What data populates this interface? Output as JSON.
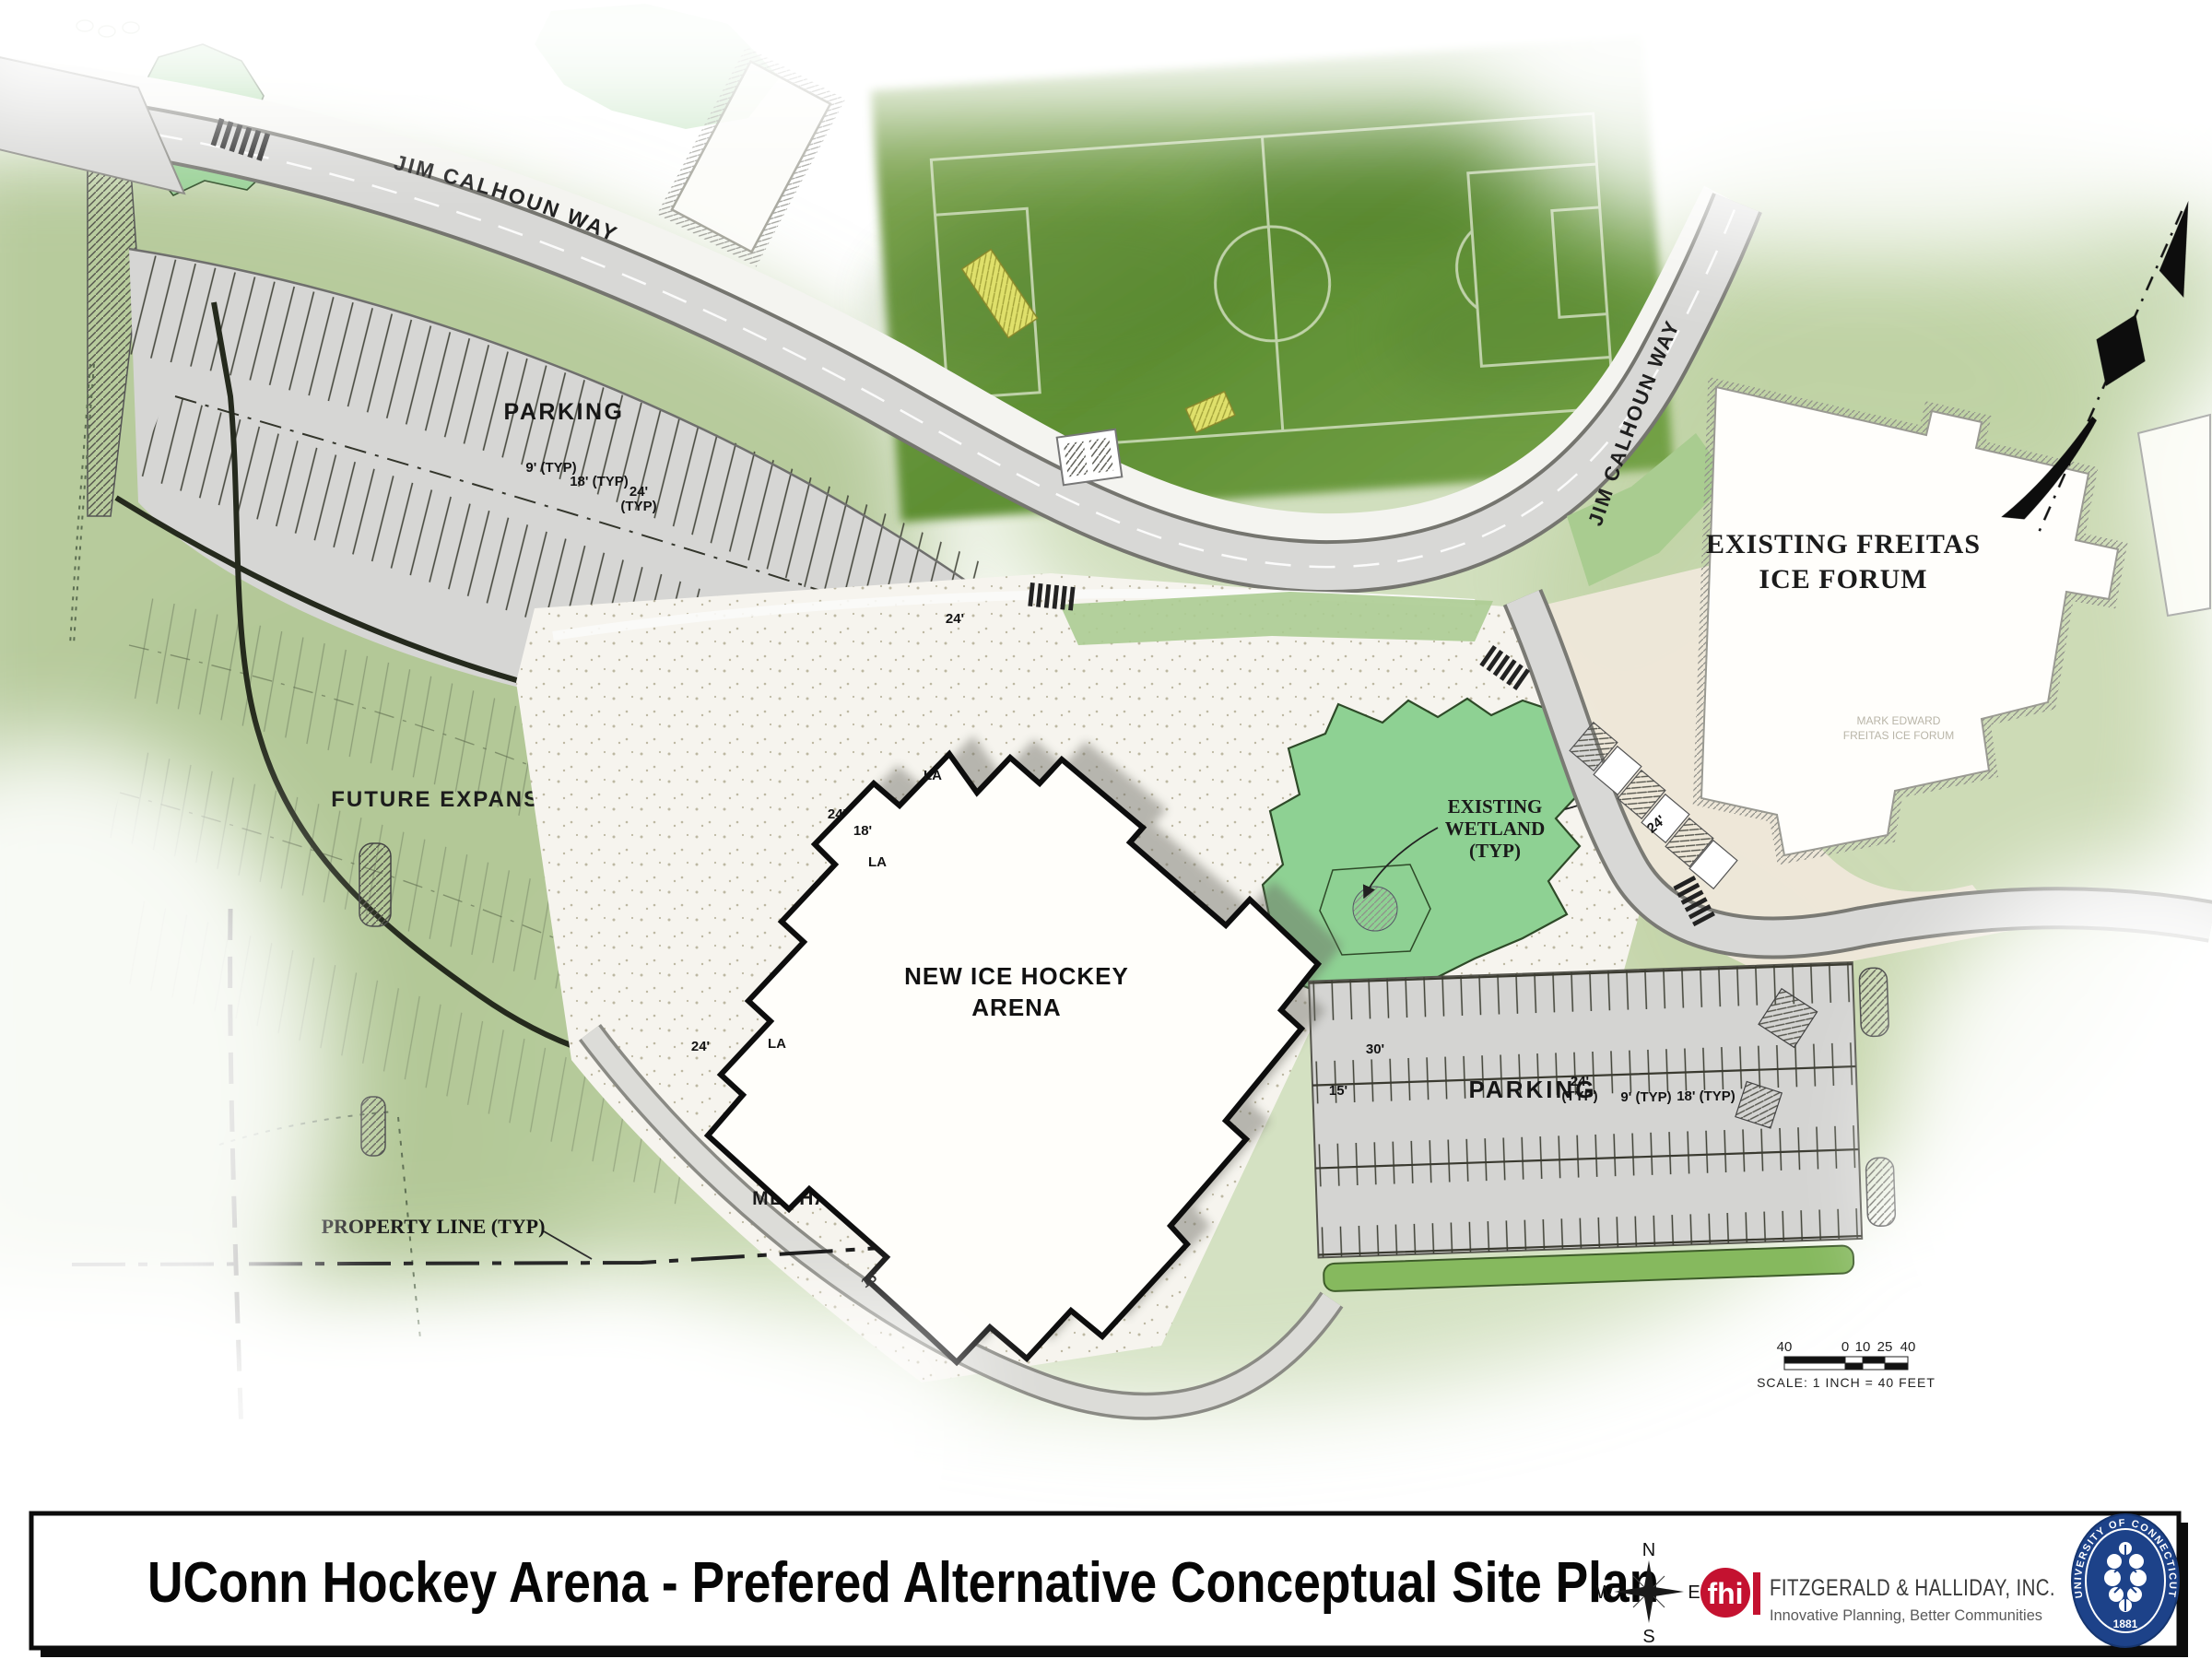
{
  "map": {
    "roads": {
      "jim_calhoun_way_upper": "JIM CALHOUN WAY",
      "jim_calhoun_way_right": "JIM CALHOUN WAY"
    },
    "areas": {
      "parking_upper": "PARKING",
      "parking_lower": "PARKING",
      "future_expansion": "FUTURE EXPANSION",
      "mechanical": "MECHANICAL AREA"
    },
    "buildings": {
      "arena_line1": "NEW ICE HOCKEY",
      "arena_line2": "ARENA",
      "freitas_line1": "EXISTING FREITAS",
      "freitas_line2": "ICE FORUM",
      "freitas_inner_line1": "MARK EDWARD",
      "freitas_inner_line2": "FREITAS ICE FORUM"
    },
    "wetland": {
      "line1": "EXISTING",
      "line2": "WETLAND",
      "line3": "(TYP)"
    },
    "property_line_label": "PROPERTY LINE (TYP)",
    "la_label": "LA",
    "dims": [
      {
        "t": "9' (TYP)"
      },
      {
        "t": "18' (TYP)"
      },
      {
        "t": "24'"
      },
      {
        "t": "(TYP)"
      },
      {
        "t": "24'"
      },
      {
        "t": "24'"
      },
      {
        "t": "18'"
      },
      {
        "t": "24'"
      },
      {
        "t": "30'"
      },
      {
        "t": "15'"
      },
      {
        "t": "24'"
      },
      {
        "t": "(TYP)"
      },
      {
        "t": "9' (TYP)"
      },
      {
        "t": "18' (TYP)"
      },
      {
        "t": "15'"
      },
      {
        "t": "24'"
      }
    ],
    "scale_bar": {
      "n1": "40",
      "n2": "0",
      "n3": "10",
      "n4": "25",
      "n5": "40",
      "caption": "SCALE: 1 INCH = 40 FEET"
    }
  },
  "title_block": {
    "title": "UConn Hockey Arena - Prefered Alternative Conceptual Site Plan",
    "compass": {
      "n": "N",
      "e": "E",
      "s": "S",
      "w": "W"
    },
    "firm": {
      "mark": "fhi",
      "name": "FITZGERALD & HALLIDAY, INC.",
      "tagline": "Innovative Planning, Better Communities"
    },
    "seal": {
      "ring": "UNIVERSITY OF CONNECTICUT",
      "year": "1881"
    }
  },
  "colors": {
    "accent_red": "#c41230",
    "seal_navy": "#1d4289"
  }
}
